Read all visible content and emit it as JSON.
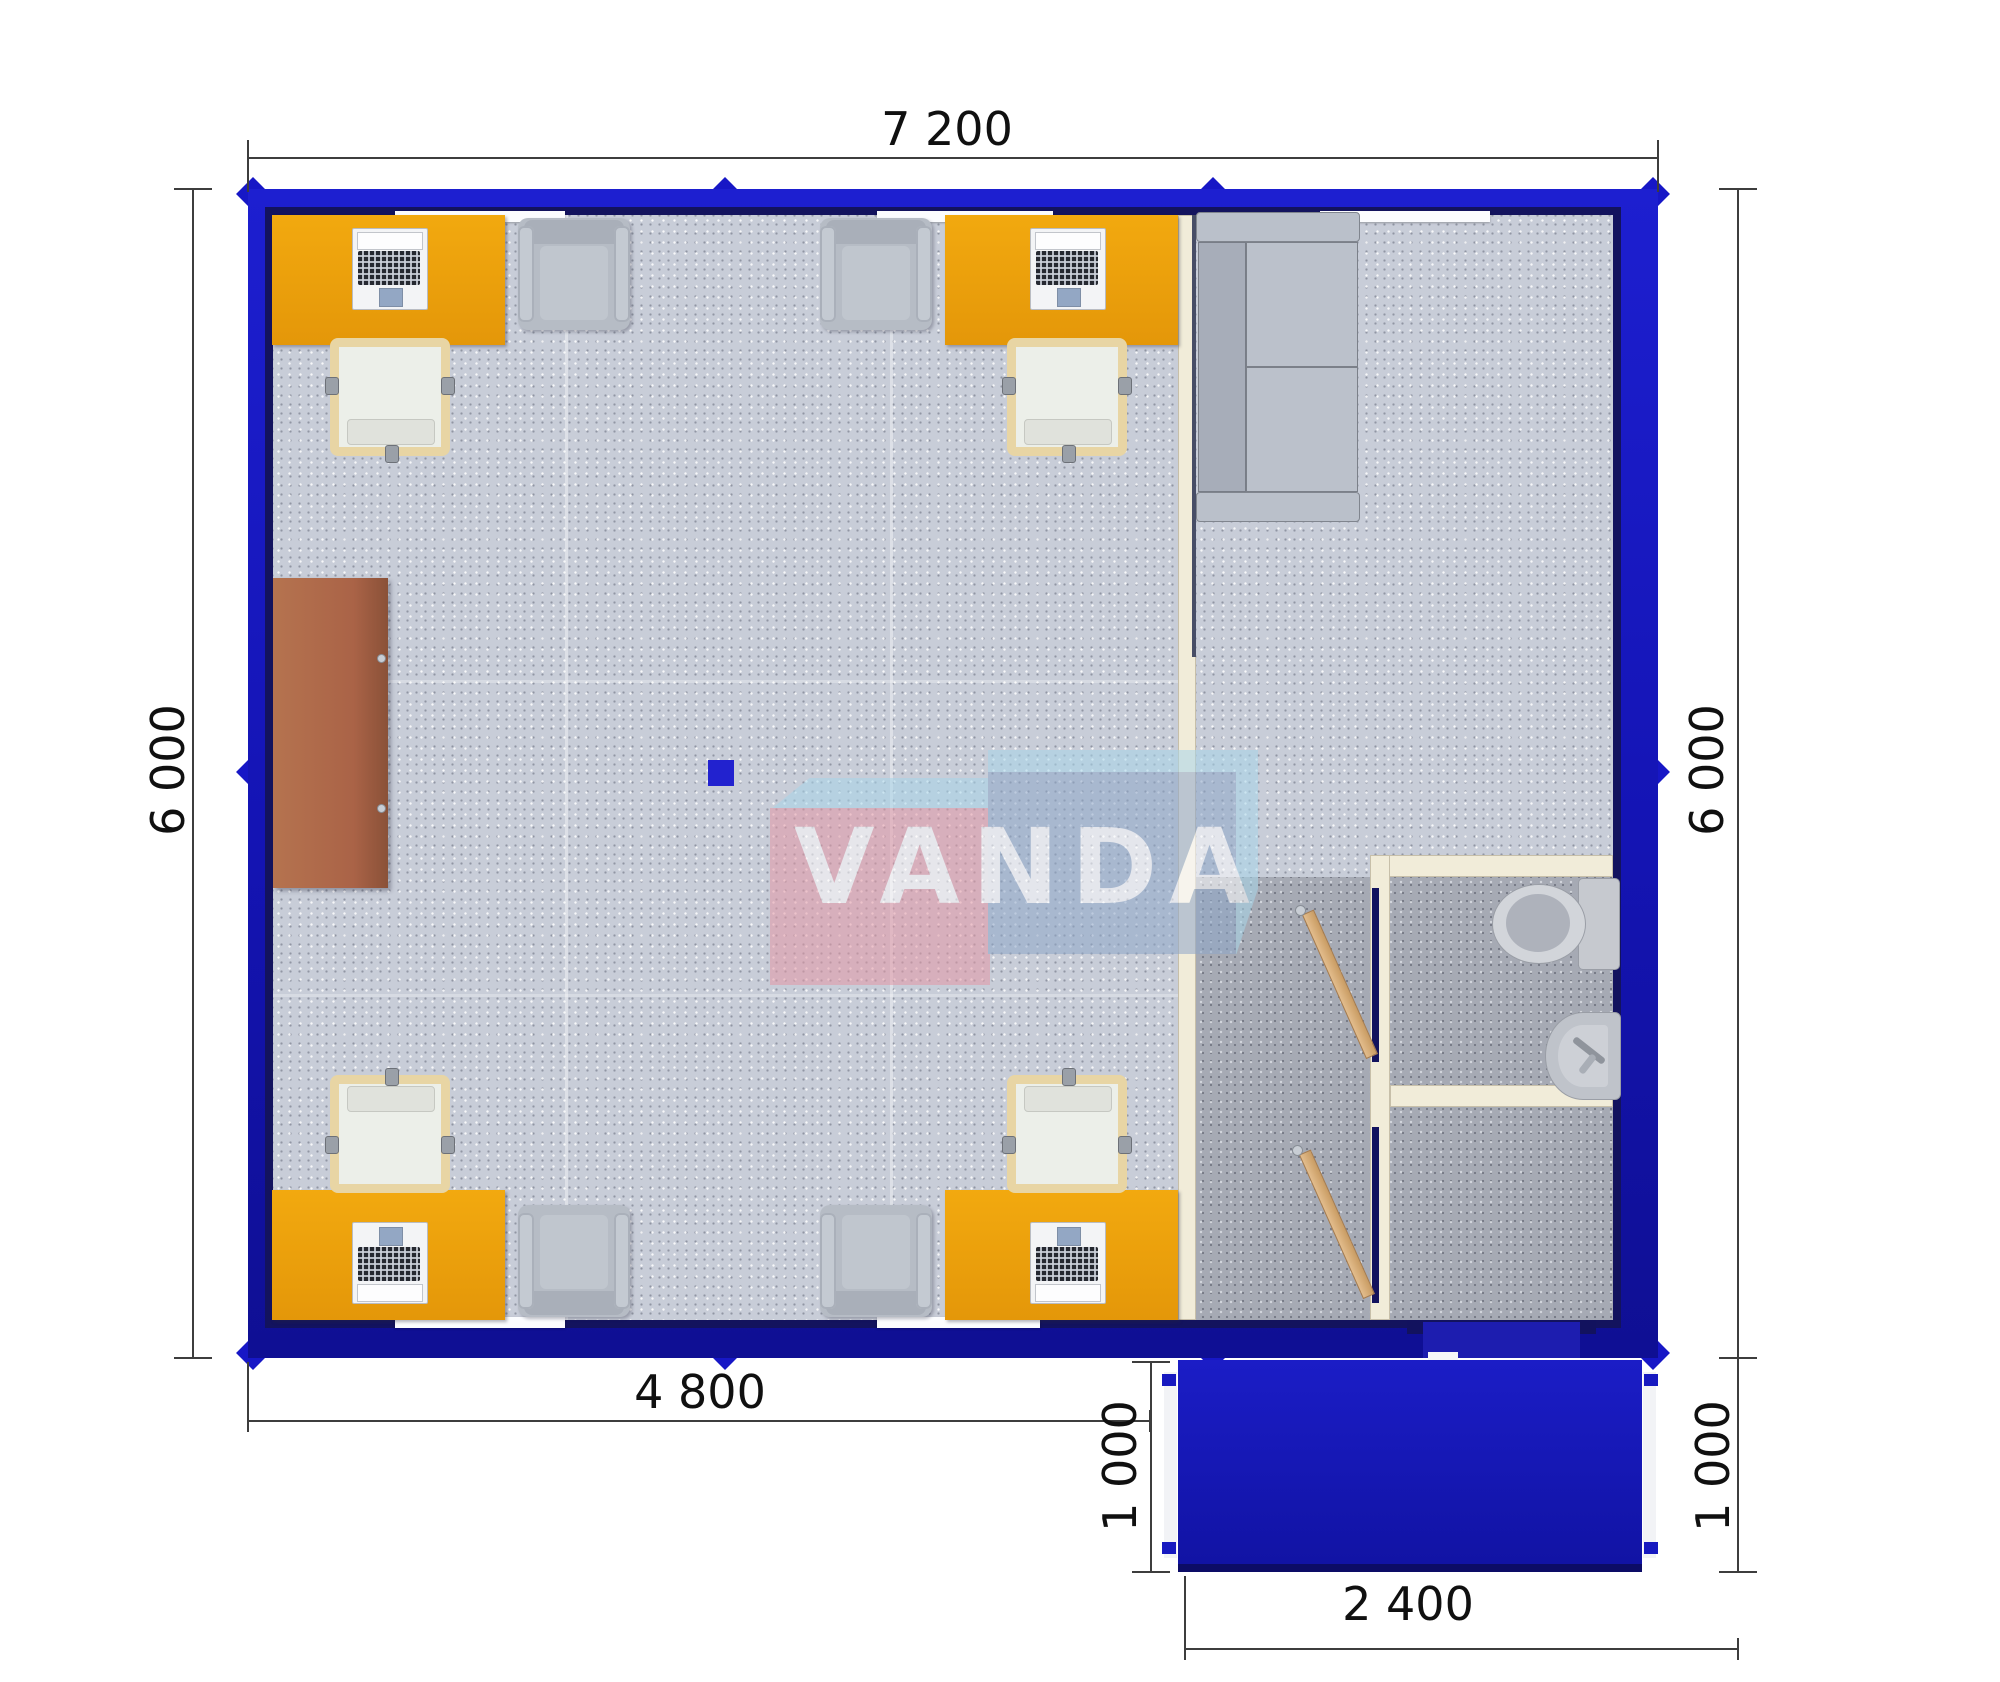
{
  "watermark": {
    "text": "VANDA"
  },
  "dimensions": {
    "top_width": "7 200",
    "left_height": "6 000",
    "right_height": "6 000",
    "office_width": "4 800",
    "porch_depth_left": "1 000",
    "porch_depth_right": "1 000",
    "porch_width": "2 400"
  },
  "colors": {
    "wall_blue": "#1717c0",
    "wall_navy": "#13135e",
    "porch_blue": "#1518b8",
    "desk_orange": "#e99d0e",
    "carpet_light": "#c8cdd8",
    "carpet_dark": "#a6aab4",
    "partition_cream": "#f1ecd9",
    "cabinet_brown": "#ab6950",
    "sofa_gray": "#b5bbc5",
    "logo_pink": "#e498a6",
    "logo_steel_blue": "#8fa7c9",
    "logo_light_blue": "#a9d6ea",
    "wood_door": "#d9b183"
  },
  "furniture": [
    "office-desk",
    "laptop",
    "office-chair",
    "visitor-chair",
    "sofa",
    "storage-cabinet",
    "toilet",
    "sink",
    "wooden-door",
    "entrance-door",
    "porch-step",
    "floor-socket"
  ]
}
